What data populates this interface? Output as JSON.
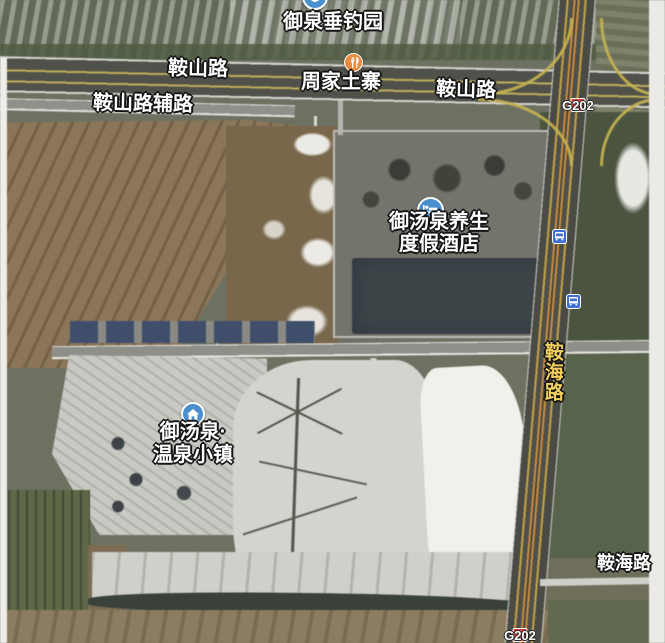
{
  "map": {
    "view_type": "satellite",
    "pois": {
      "fishing_park": {
        "name": "御泉垂钓园",
        "icon": "fishing-park-icon"
      },
      "restaurant": {
        "name": "周家土寨",
        "icon": "restaurant-icon"
      },
      "hotel": {
        "name_line1": "御汤泉养生",
        "name_line2": "度假酒店",
        "icon": "hotel-bed-icon"
      },
      "town": {
        "name_line1": "御汤泉·",
        "name_line2": "温泉小镇",
        "icon": "home-icon"
      }
    },
    "roads": {
      "anshan_left": "鞍山路",
      "anshan_service": "鞍山路辅路",
      "anshan_right": "鞍山路",
      "anhai_vertical": "鞍海路",
      "anhai_bottom": "鞍海路",
      "g202_top": "G202",
      "g202_bottom": "G202"
    },
    "colors": {
      "road_label_text": "#ffffff",
      "highway_label_text": "#f2cf5e",
      "label_outline": "#141414",
      "g202_badge_red": "#d7403a",
      "poi_icon_blue": "#4a8fd0",
      "restaurant_icon_orange": "#ed8a3f",
      "bus_icon_blue": "#3f6fd1",
      "highway_line_yellow": "#c9b44a",
      "highway_line_orange": "#cc8d38"
    }
  }
}
